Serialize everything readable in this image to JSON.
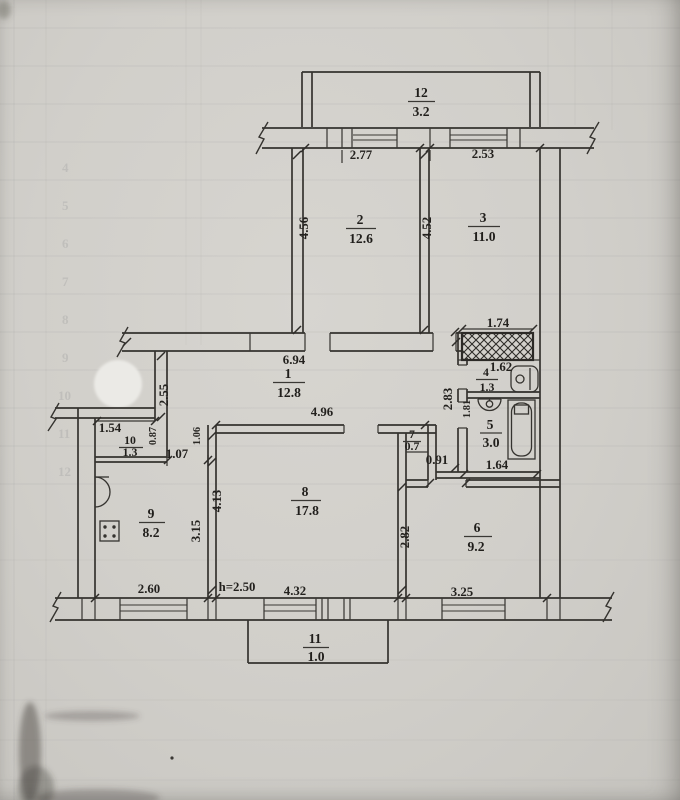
{
  "plan": {
    "rooms": {
      "r1": {
        "num": "1",
        "area": "12.8"
      },
      "r2": {
        "num": "2",
        "area": "12.6"
      },
      "r3": {
        "num": "3",
        "area": "11.0"
      },
      "r4": {
        "num": "4",
        "area": "1.3"
      },
      "r5": {
        "num": "5",
        "area": "3.0"
      },
      "r6": {
        "num": "6",
        "area": "9.2"
      },
      "r7": {
        "num": "7",
        "area": "0.7"
      },
      "r8": {
        "num": "8",
        "area": "17.8"
      },
      "r9": {
        "num": "9",
        "area": "8.2"
      },
      "r10": {
        "num": "10",
        "area": "1.3"
      },
      "r11": {
        "num": "11",
        "area": "1.0"
      },
      "r12": {
        "num": "12",
        "area": "3.2"
      }
    },
    "dims": {
      "facade_top_left": "2.77",
      "facade_top_right": "2.53",
      "room2_depth": "4.56",
      "room3_depth": "4.52",
      "shaft_width": "1.74",
      "hallway_width": "6.94",
      "wc_width": "1.62",
      "sanitary_block_depth": "2.83",
      "bathroom_depth": "1.81",
      "bathroom_width": "1.64",
      "hallway_left_depth": "2.55",
      "room10_width": "1.54",
      "room10_opening": "0.87",
      "hallway_door_width": "1.07",
      "room8_wall_segment": "1.06",
      "room8_top_width": "4.96",
      "room8_depth": "4.13",
      "room9_depth": "3.15",
      "room6_depth": "2.82",
      "room6_door_width": "0.91",
      "room9_width": "2.60",
      "ceiling_height": "h=2.50",
      "room8_width": "4.32",
      "room6_width": "3.25"
    }
  },
  "artifacts": {
    "ghost_numbers": [
      "4",
      "5",
      "6",
      "7",
      "8",
      "9",
      "10",
      "11",
      "12"
    ]
  }
}
